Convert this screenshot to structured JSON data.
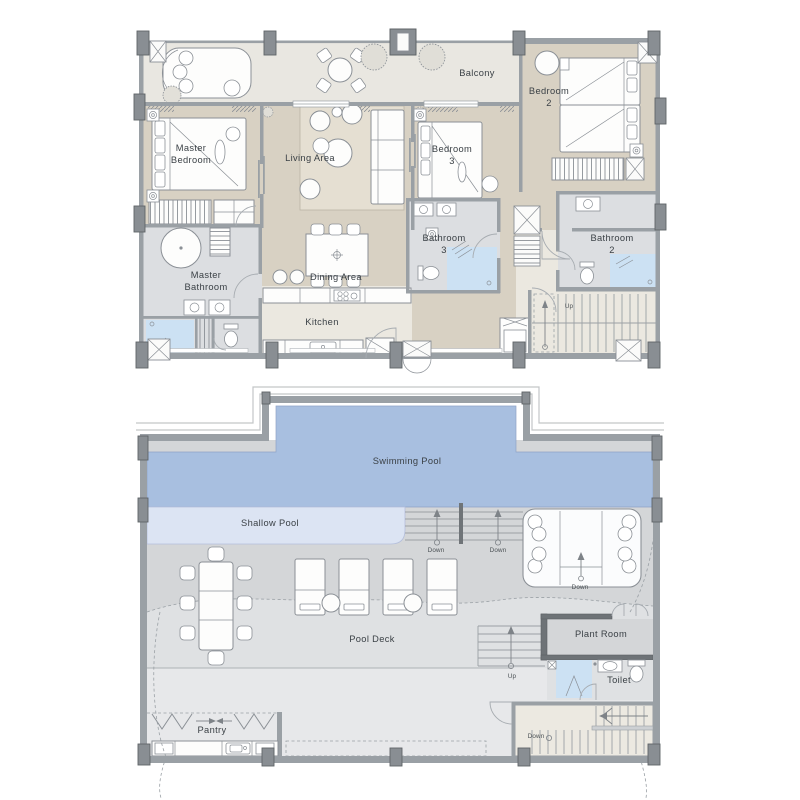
{
  "document": {
    "type": "Architectural floor plans",
    "sheets": [
      "Upper floor plan",
      "Pool deck plan"
    ]
  },
  "colors": {
    "floor": "#d8d1c3",
    "balcony": "#e9e7e1",
    "cream": "#ebe8e0",
    "bath": "#dcdee1",
    "shower": "#cce1f3",
    "pool": "#a8bfe0",
    "shallow": "#dce4f3",
    "deck1": "#d4d6d8",
    "deck2": "#dfe1e3",
    "deck3": "#e7e8ea",
    "cream2": "#ece9e1",
    "rug": "#e5dfd2",
    "wall": "#9aa0a5",
    "walld": "#6e7377",
    "line": "#8b9096",
    "text": "#3b4146"
  },
  "floor1": {
    "name": "Upper floor plan",
    "labels": {
      "balcony": "Balcony",
      "bedroom2": "Bedroom\n2",
      "master_bedroom": "Master\nBedroom",
      "living_area": "Living Area",
      "bedroom3": "Bedroom\n3",
      "bathroom3": "Bathroom\n3",
      "bathroom2": "Bathroom\n2",
      "master_bathroom": "Master\nBathroom",
      "dining_area": "Dining Area",
      "kitchen": "Kitchen",
      "up": "Up"
    }
  },
  "floor2": {
    "name": "Pool deck plan",
    "labels": {
      "swimming_pool": "Swimming Pool",
      "shallow_pool": "Shallow Pool",
      "down_steps_left": "Down",
      "down_steps_right": "Down",
      "down_lounge": "Down",
      "pool_deck": "Pool Deck",
      "up": "Up",
      "plant_room": "Plant Room",
      "toilet": "Toilet",
      "down_stairs": "Down",
      "pantry": "Pantry"
    }
  }
}
